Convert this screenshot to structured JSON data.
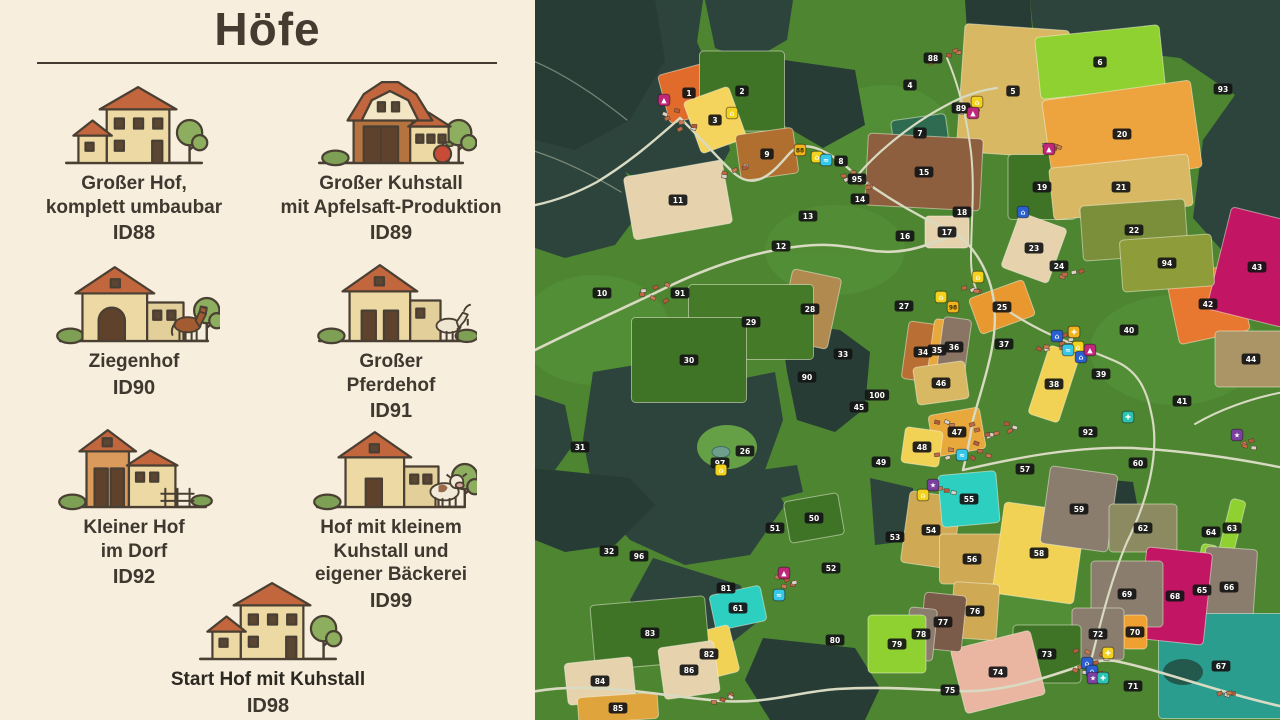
{
  "panel": {
    "title": "Höfe",
    "farms": [
      {
        "lines": [
          "Großer Hof,",
          "komplett umbaubar"
        ],
        "id": "ID88",
        "icon": "farmhouse"
      },
      {
        "lines": [
          "Großer Kuhstall",
          "mit Apfelsaft-Produktion"
        ],
        "id": "ID89",
        "icon": "barn-apple"
      },
      {
        "lines": [
          "Ziegenhof"
        ],
        "id": "ID90",
        "icon": "barn-horse"
      },
      {
        "lines": [
          "Großer",
          "Pferdehof"
        ],
        "id": "ID91",
        "icon": "barn-goat"
      },
      {
        "lines": [
          "Kleiner Hof",
          "im Dorf"
        ],
        "id": "ID92",
        "icon": "barn-fence"
      },
      {
        "lines": [
          "Hof mit kleinem",
          "Kuhstall und",
          "eigener Bäckerei"
        ],
        "id": "ID99",
        "icon": "barn-cow"
      },
      {
        "lines": [
          "Start Hof mit Kuhstall"
        ],
        "id": "ID98",
        "icon": "farmhouse",
        "emphasis": true
      }
    ]
  },
  "map": {
    "palette": {
      "grass": "#4d8531",
      "grass_light": "#57953a",
      "forest": "#2d443c",
      "forest_dark": "#273c35",
      "road": "#d8dac2",
      "label_bg": "#151515",
      "label_text": "#ffffff",
      "marker_yellow": "#f2d21c",
      "marker_orange": "#f0b31c",
      "marker_magenta": "#c0267a",
      "marker_blue": "#2a5fd0",
      "marker_cyan": "#35c8e8",
      "marker_teal": "#2bc4b2",
      "marker_purple": "#7b3fa0"
    },
    "fields": [
      {
        "n": "1",
        "x": 154,
        "y": 93,
        "fill": "#e06b2b",
        "w": 52,
        "h": 50,
        "rot": -15
      },
      {
        "n": "2",
        "x": 207,
        "y": 91,
        "fill": "#3f7426",
        "w": 85,
        "h": 80,
        "rot": 0
      },
      {
        "n": "3",
        "x": 180,
        "y": 120,
        "fill": "#f5d45e",
        "w": 48,
        "h": 55,
        "rot": -20
      },
      {
        "n": "4",
        "x": 375,
        "y": 85
      },
      {
        "n": "5",
        "x": 478,
        "y": 91,
        "fill": "#d9b863",
        "w": 105,
        "h": 128,
        "rot": 4
      },
      {
        "n": "6",
        "x": 565,
        "y": 62,
        "fill": "#8fd130",
        "w": 125,
        "h": 62,
        "rot": -6
      },
      {
        "n": "7",
        "x": 385,
        "y": 133,
        "fill": "#2f6b50",
        "w": 55,
        "h": 32,
        "rot": -8
      },
      {
        "n": "8",
        "x": 306,
        "y": 161
      },
      {
        "n": "9",
        "x": 232,
        "y": 154,
        "fill": "#b06f2e",
        "w": 58,
        "h": 46,
        "rot": -8
      },
      {
        "n": "10",
        "x": 67,
        "y": 293
      },
      {
        "n": "11",
        "x": 143,
        "y": 200,
        "fill": "#e6d3ae",
        "w": 100,
        "h": 64,
        "rot": -10
      },
      {
        "n": "12",
        "x": 246,
        "y": 246
      },
      {
        "n": "13",
        "x": 273,
        "y": 216
      },
      {
        "n": "14",
        "x": 325,
        "y": 199
      },
      {
        "n": "15",
        "x": 389,
        "y": 172,
        "fill": "#8d5f3f",
        "w": 115,
        "h": 72,
        "rot": 3
      },
      {
        "n": "16",
        "x": 370,
        "y": 236
      },
      {
        "n": "17",
        "x": 412,
        "y": 232,
        "fill": "#e6d3ae",
        "w": 44,
        "h": 32,
        "rot": 0
      },
      {
        "n": "18",
        "x": 427,
        "y": 212
      },
      {
        "n": "19",
        "x": 507,
        "y": 187,
        "fill": "#3f7426",
        "w": 68,
        "h": 65,
        "rot": 0
      },
      {
        "n": "20",
        "x": 587,
        "y": 134,
        "fill": "#eda43f",
        "w": 150,
        "h": 88,
        "rot": -8
      },
      {
        "n": "21",
        "x": 586,
        "y": 187,
        "fill": "#d9b863",
        "w": 140,
        "h": 52,
        "rot": -6
      },
      {
        "n": "22",
        "x": 599,
        "y": 230,
        "fill": "#7b8f3a",
        "w": 105,
        "h": 55,
        "rot": -4
      },
      {
        "n": "23",
        "x": 499,
        "y": 248,
        "fill": "#e6d3ae",
        "w": 50,
        "h": 58,
        "rot": 20
      },
      {
        "n": "24",
        "x": 524,
        "y": 266
      },
      {
        "n": "25",
        "x": 467,
        "y": 307,
        "fill": "#e8982f",
        "w": 58,
        "h": 38,
        "rot": -20
      },
      {
        "n": "26",
        "x": 210,
        "y": 451
      },
      {
        "n": "27",
        "x": 369,
        "y": 306
      },
      {
        "n": "28",
        "x": 275,
        "y": 309,
        "fill": "#b08a4e",
        "w": 50,
        "h": 72,
        "rot": 12
      },
      {
        "n": "29",
        "x": 216,
        "y": 322,
        "fill": "#447a28",
        "w": 125,
        "h": 75,
        "rot": 0
      },
      {
        "n": "30",
        "x": 154,
        "y": 360,
        "fill": "#3f7426",
        "w": 115,
        "h": 85,
        "rot": 0
      },
      {
        "n": "31",
        "x": 45,
        "y": 447
      },
      {
        "n": "32",
        "x": 74,
        "y": 551
      },
      {
        "n": "33",
        "x": 308,
        "y": 354
      },
      {
        "n": "34",
        "x": 388,
        "y": 352,
        "fill": "#b96f33",
        "w": 36,
        "h": 58,
        "rot": 8
      },
      {
        "n": "35",
        "x": 402,
        "y": 350,
        "fill": "#e8a83c",
        "w": 13,
        "h": 62,
        "rot": 8
      },
      {
        "n": "36",
        "x": 419,
        "y": 347,
        "fill": "#8a7565",
        "w": 28,
        "h": 58,
        "rot": 8
      },
      {
        "n": "37",
        "x": 469,
        "y": 344
      },
      {
        "n": "38",
        "x": 519,
        "y": 384,
        "fill": "#f2d255",
        "w": 32,
        "h": 72,
        "rot": 18
      },
      {
        "n": "39",
        "x": 566,
        "y": 374
      },
      {
        "n": "40",
        "x": 594,
        "y": 330
      },
      {
        "n": "41",
        "x": 647,
        "y": 401
      },
      {
        "n": "42",
        "x": 673,
        "y": 304,
        "fill": "#e87830",
        "w": 72,
        "h": 68,
        "rot": -12
      },
      {
        "n": "43",
        "x": 722,
        "y": 267,
        "fill": "#c21563",
        "w": 78,
        "h": 105,
        "rot": 14
      },
      {
        "n": "44",
        "x": 716,
        "y": 359,
        "fill": "#ab9566",
        "w": 72,
        "h": 56,
        "rot": 0
      },
      {
        "n": "45",
        "x": 324,
        "y": 407
      },
      {
        "n": "46",
        "x": 406,
        "y": 383,
        "fill": "#d9b863",
        "w": 52,
        "h": 38,
        "rot": -8
      },
      {
        "n": "47",
        "x": 422,
        "y": 432,
        "fill": "#e8a83c",
        "w": 52,
        "h": 42,
        "rot": -10
      },
      {
        "n": "48",
        "x": 387,
        "y": 447,
        "fill": "#f2d255",
        "w": 38,
        "h": 36,
        "rot": 8
      },
      {
        "n": "49",
        "x": 346,
        "y": 462
      },
      {
        "n": "50",
        "x": 279,
        "y": 518,
        "fill": "#3f7426",
        "w": 55,
        "h": 42,
        "rot": -10
      },
      {
        "n": "51",
        "x": 240,
        "y": 528
      },
      {
        "n": "52",
        "x": 296,
        "y": 568
      },
      {
        "n": "53",
        "x": 360,
        "y": 537
      },
      {
        "n": "54",
        "x": 396,
        "y": 530,
        "fill": "#cfa953",
        "w": 52,
        "h": 72,
        "rot": 8
      },
      {
        "n": "55",
        "x": 434,
        "y": 499,
        "fill": "#2dcfc0",
        "w": 58,
        "h": 52,
        "rot": -5
      },
      {
        "n": "56",
        "x": 437,
        "y": 559,
        "fill": "#cfa953",
        "w": 65,
        "h": 50,
        "rot": 0
      },
      {
        "n": "57",
        "x": 490,
        "y": 469
      },
      {
        "n": "58",
        "x": 504,
        "y": 553,
        "fill": "#f2d255",
        "w": 82,
        "h": 92,
        "rot": 8
      },
      {
        "n": "59",
        "x": 544,
        "y": 509,
        "fill": "#8b7d6e",
        "w": 68,
        "h": 78,
        "rot": 8
      },
      {
        "n": "60",
        "x": 603,
        "y": 463
      },
      {
        "n": "61",
        "x": 203,
        "y": 608,
        "fill": "#2dcfc0",
        "w": 52,
        "h": 36,
        "rot": -12
      },
      {
        "n": "62",
        "x": 608,
        "y": 528,
        "fill": "#8b8a60",
        "w": 68,
        "h": 48,
        "rot": 0
      },
      {
        "n": "63",
        "x": 697,
        "y": 528,
        "fill": "#8fd130",
        "w": 15,
        "h": 58,
        "rot": 14
      },
      {
        "n": "64",
        "x": 676,
        "y": 532
      },
      {
        "n": "65",
        "x": 667,
        "y": 590,
        "fill": "#8fd130",
        "w": 16,
        "h": 92,
        "rot": 10
      },
      {
        "n": "66",
        "x": 694,
        "y": 587,
        "fill": "#8b7d6e",
        "w": 52,
        "h": 78,
        "rot": 4
      },
      {
        "n": "67",
        "x": 686,
        "y": 666,
        "fill": "#2a9d8f",
        "w": 125,
        "h": 105,
        "rot": 0
      },
      {
        "n": "68",
        "x": 640,
        "y": 596,
        "fill": "#c21563",
        "w": 66,
        "h": 92,
        "rot": 6
      },
      {
        "n": "69",
        "x": 592,
        "y": 594,
        "fill": "#8b7d6e",
        "w": 72,
        "h": 66,
        "rot": 0
      },
      {
        "n": "70",
        "x": 600,
        "y": 632,
        "fill": "#f0a030",
        "w": 24,
        "h": 34,
        "rot": 0
      },
      {
        "n": "71",
        "x": 598,
        "y": 686
      },
      {
        "n": "72",
        "x": 563,
        "y": 634,
        "fill": "#8b7d6e",
        "w": 52,
        "h": 52,
        "rot": 0
      },
      {
        "n": "73",
        "x": 512,
        "y": 654,
        "fill": "#3f7426",
        "w": 68,
        "h": 58,
        "rot": 0
      },
      {
        "n": "74",
        "x": 463,
        "y": 672,
        "fill": "#eab6a2",
        "w": 82,
        "h": 66,
        "rot": -14
      },
      {
        "n": "75",
        "x": 415,
        "y": 690
      },
      {
        "n": "76",
        "x": 440,
        "y": 611,
        "fill": "#cfa953",
        "w": 46,
        "h": 56,
        "rot": 4
      },
      {
        "n": "77",
        "x": 408,
        "y": 622,
        "fill": "#7a5a48",
        "w": 42,
        "h": 56,
        "rot": 6
      },
      {
        "n": "78",
        "x": 386,
        "y": 634,
        "fill": "#8b7d6e",
        "w": 28,
        "h": 52,
        "rot": 6
      },
      {
        "n": "79",
        "x": 362,
        "y": 644,
        "fill": "#8fd130",
        "w": 58,
        "h": 58,
        "rot": 0
      },
      {
        "n": "80",
        "x": 300,
        "y": 640
      },
      {
        "n": "81",
        "x": 191,
        "y": 588
      },
      {
        "n": "82",
        "x": 174,
        "y": 654,
        "fill": "#f2d255",
        "w": 52,
        "h": 48,
        "rot": -14
      },
      {
        "n": "83",
        "x": 115,
        "y": 633,
        "fill": "#3f7426",
        "w": 115,
        "h": 65,
        "rot": -5
      },
      {
        "n": "84",
        "x": 65,
        "y": 681,
        "fill": "#e6d3ae",
        "w": 68,
        "h": 42,
        "rot": -6
      },
      {
        "n": "85",
        "x": 83,
        "y": 708,
        "fill": "#e0a43c",
        "w": 80,
        "h": 26,
        "rot": -4
      },
      {
        "n": "86",
        "x": 154,
        "y": 670,
        "fill": "#e6d3ae",
        "w": 56,
        "h": 52,
        "rot": -8
      },
      {
        "n": "88",
        "x": 398,
        "y": 58
      },
      {
        "n": "89",
        "x": 426,
        "y": 108
      },
      {
        "n": "90",
        "x": 272,
        "y": 377
      },
      {
        "n": "91",
        "x": 145,
        "y": 293
      },
      {
        "n": "92",
        "x": 553,
        "y": 432
      },
      {
        "n": "93",
        "x": 688,
        "y": 89
      },
      {
        "n": "94",
        "x": 632,
        "y": 263,
        "fill": "#8f9c3a",
        "w": 92,
        "h": 52,
        "rot": -4
      },
      {
        "n": "95",
        "x": 322,
        "y": 179
      },
      {
        "n": "96",
        "x": 104,
        "y": 556
      },
      {
        "n": "97",
        "x": 185,
        "y": 463
      },
      {
        "n": "100",
        "x": 342,
        "y": 395
      }
    ],
    "markers": [
      {
        "x": 129,
        "y": 100,
        "color": "#c0267a",
        "icon": "statue-icon",
        "glyph": "▲"
      },
      {
        "x": 197,
        "y": 113,
        "color": "#f2d21c",
        "icon": "farm-poi-icon",
        "glyph": "⌂"
      },
      {
        "x": 265,
        "y": 150,
        "color": "#f0b31c",
        "icon": "field-88-marker",
        "glyph": "88",
        "text": true
      },
      {
        "x": 282,
        "y": 157,
        "color": "#f2d21c",
        "icon": "farm-poi-icon",
        "glyph": "⌂"
      },
      {
        "x": 291,
        "y": 160,
        "color": "#35c8e8",
        "icon": "water-poi-icon",
        "glyph": "≈"
      },
      {
        "x": 443,
        "y": 277,
        "color": "#f2d21c",
        "icon": "farm-poi-icon",
        "glyph": "⌂"
      },
      {
        "x": 406,
        "y": 297,
        "color": "#f2d21c",
        "icon": "farm-poi-icon",
        "glyph": "⌂"
      },
      {
        "x": 418,
        "y": 307,
        "color": "#f0b31c",
        "icon": "field-98-marker",
        "glyph": "98",
        "text": true
      },
      {
        "x": 442,
        "y": 102,
        "color": "#f2d21c",
        "icon": "farm-poi-icon",
        "glyph": "⌂"
      },
      {
        "x": 438,
        "y": 113,
        "color": "#c0267a",
        "icon": "statue-icon",
        "glyph": "▲"
      },
      {
        "x": 514,
        "y": 149,
        "color": "#c0267a",
        "icon": "statue-icon",
        "glyph": "▲"
      },
      {
        "x": 488,
        "y": 212,
        "color": "#2a5fd0",
        "icon": "shop-poi-icon",
        "glyph": "⌂"
      },
      {
        "x": 522,
        "y": 336,
        "color": "#2a5fd0",
        "icon": "shop-poi-icon",
        "glyph": "⌂"
      },
      {
        "x": 539,
        "y": 332,
        "color": "#f0b31c",
        "icon": "production-poi-icon",
        "glyph": "✚"
      },
      {
        "x": 543,
        "y": 347,
        "color": "#f2d21c",
        "icon": "farm-poi-icon",
        "glyph": "⌂"
      },
      {
        "x": 533,
        "y": 350,
        "color": "#35c8e8",
        "icon": "water-poi-icon",
        "glyph": "≈"
      },
      {
        "x": 546,
        "y": 357,
        "color": "#2a5fd0",
        "icon": "shop-poi-icon",
        "glyph": "⌂"
      },
      {
        "x": 555,
        "y": 350,
        "color": "#c0267a",
        "icon": "statue-icon",
        "glyph": "▲"
      },
      {
        "x": 593,
        "y": 417,
        "color": "#2bc4b2",
        "icon": "production-poi-icon",
        "glyph": "✚"
      },
      {
        "x": 427,
        "y": 455,
        "color": "#35c8e8",
        "icon": "water-poi-icon",
        "glyph": "≈"
      },
      {
        "x": 702,
        "y": 435,
        "color": "#7b3fa0",
        "icon": "special-poi-icon",
        "glyph": "★"
      },
      {
        "x": 186,
        "y": 470,
        "color": "#f2d21c",
        "icon": "farm-poi-icon",
        "glyph": "⌂"
      },
      {
        "x": 249,
        "y": 573,
        "color": "#c0267a",
        "icon": "statue-icon",
        "glyph": "▲"
      },
      {
        "x": 244,
        "y": 595,
        "color": "#35c8e8",
        "icon": "water-poi-icon",
        "glyph": "≈"
      },
      {
        "x": 398,
        "y": 485,
        "color": "#7b3fa0",
        "icon": "special-poi-icon",
        "glyph": "★"
      },
      {
        "x": 388,
        "y": 495,
        "color": "#f2d21c",
        "icon": "farm-poi-icon",
        "glyph": "⌂"
      },
      {
        "x": 573,
        "y": 653,
        "color": "#f2d21c",
        "icon": "production-poi-icon",
        "glyph": "✚"
      },
      {
        "x": 552,
        "y": 663,
        "color": "#2a5fd0",
        "icon": "shop-poi-icon",
        "glyph": "⌂"
      },
      {
        "x": 557,
        "y": 671,
        "color": "#2a5fd0",
        "icon": "shop-poi-icon",
        "glyph": "⌂"
      },
      {
        "x": 558,
        "y": 678,
        "color": "#7b3fa0",
        "icon": "special-poi-icon",
        "glyph": "★"
      },
      {
        "x": 568,
        "y": 678,
        "color": "#2bc4b2",
        "icon": "production-poi-icon",
        "glyph": "✚"
      }
    ]
  }
}
